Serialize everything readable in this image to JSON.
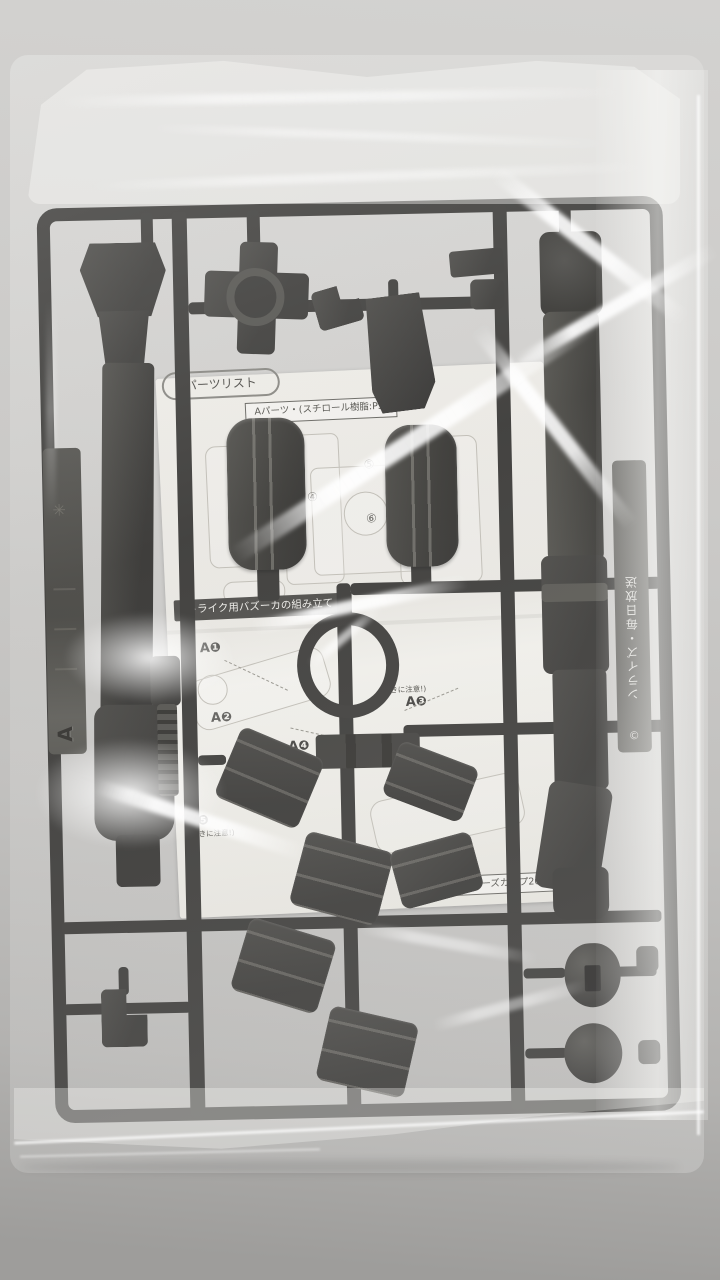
{
  "photo": {
    "subject": "Black plastic model-kit runner A with bazooka parts and a folded instruction sheet, sealed in a clear plastic bag lying on a gray surface",
    "colors": {
      "surface": "#c7c6c4",
      "runner": "#2e2d2b",
      "paper": "#e9e8e3",
      "bag_glare": "#ffffff"
    }
  },
  "runner": {
    "left_tag": {
      "letter": "A",
      "resin_mark": "✳"
    },
    "right_tag": {
      "text": "ンライズ・毎日放送",
      "copyright": "©"
    }
  },
  "sheet": {
    "header": "パーツリスト",
    "material_label": "Aパーツ・(スチロール樹脂:PS)",
    "assembly_title": "トライク用バズーカの組み立て",
    "steps": [
      {
        "label": "A❶"
      },
      {
        "label": "A❷"
      },
      {
        "label": "A❸",
        "note": "(向きに注意!)"
      },
      {
        "label": "A❹"
      },
      {
        "label": "A❺",
        "note": "(向きに注意!)"
      }
    ],
    "part_numbers": [
      "④",
      "⑤",
      "⑥"
    ],
    "footer_note": "「モデラーズカップ2005」"
  }
}
